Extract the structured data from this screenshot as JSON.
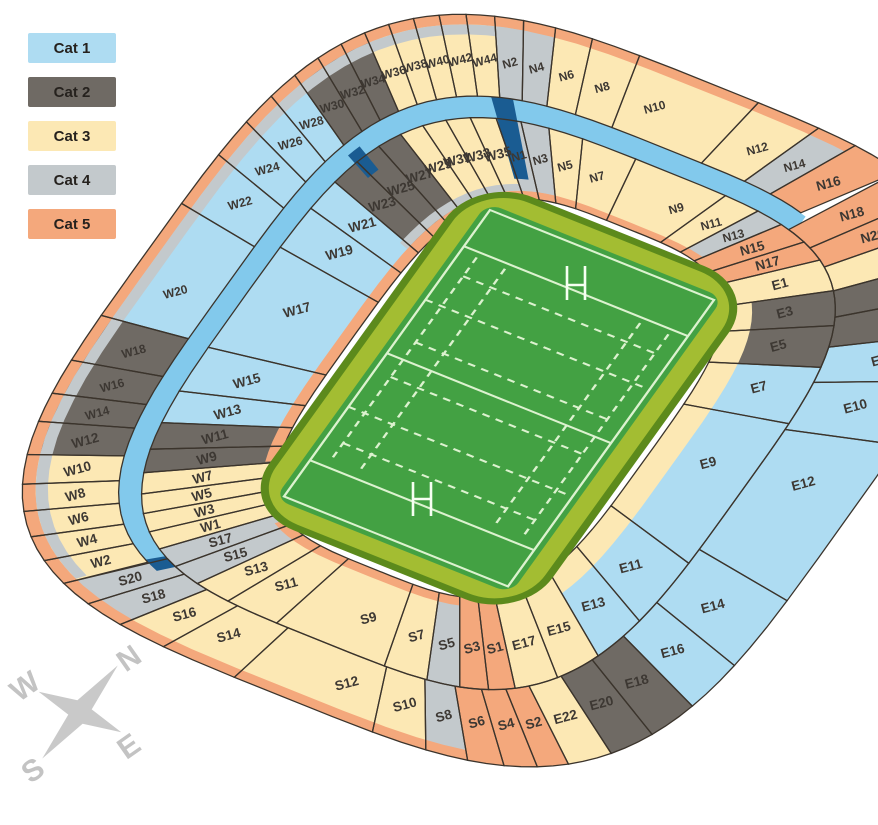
{
  "legend": {
    "items": [
      {
        "label": "Cat 1",
        "color": "#aedcf2"
      },
      {
        "label": "Cat 2",
        "color": "#6f6a64"
      },
      {
        "label": "Cat 3",
        "color": "#fce8b4"
      },
      {
        "label": "Cat 4",
        "color": "#c3c9cc"
      },
      {
        "label": "Cat 5",
        "color": "#f4a87c"
      }
    ]
  },
  "colors": {
    "walkway": "#82c9ec",
    "navy": "#1a5c92",
    "surround": "#a3bd32",
    "surround_edge": "#5c8a1c",
    "pitch": "#43a143",
    "pitch_line": "#dcf2cf",
    "border": "#3b342c",
    "label_text": "#3d3833",
    "compass": "#c9c9c9"
  },
  "stadium": {
    "inner_ring": [
      {
        "label": "W1",
        "cat": 3
      },
      {
        "label": "W3",
        "cat": 3
      },
      {
        "label": "W5",
        "cat": 3
      },
      {
        "label": "W7",
        "cat": 3
      },
      {
        "label": "W9",
        "cat": 2
      },
      {
        "label": "W11",
        "cat": 2
      },
      {
        "label": "W13",
        "cat": 1
      },
      {
        "label": "W15",
        "cat": 1
      },
      {
        "label": "W17",
        "cat": 1
      },
      {
        "label": "W19",
        "cat": 1
      },
      {
        "label": "W21",
        "cat": 1
      },
      {
        "label": "W23",
        "cat": 2
      },
      {
        "label": "W25",
        "cat": 2
      },
      {
        "label": "W27",
        "cat": 2
      },
      {
        "label": "W29",
        "cat": 3
      },
      {
        "label": "W31",
        "cat": 3
      },
      {
        "label": "W33",
        "cat": 3
      },
      {
        "label": "W35",
        "cat": 3
      },
      {
        "label": "N1",
        "cat": 4
      },
      {
        "label": "N3",
        "cat": 4
      },
      {
        "label": "N5",
        "cat": 3
      },
      {
        "label": "N7",
        "cat": 3
      },
      {
        "label": "N9",
        "cat": 3
      },
      {
        "label": "N11",
        "cat": 3
      },
      {
        "label": "N13",
        "cat": 4
      },
      {
        "label": "N15",
        "cat": 5
      },
      {
        "label": "N17",
        "cat": 5
      },
      {
        "label": "E1",
        "cat": 3
      },
      {
        "label": "E3",
        "cat": 2
      },
      {
        "label": "E5",
        "cat": 2
      },
      {
        "label": "E7",
        "cat": 1
      },
      {
        "label": "E9",
        "cat": 1
      },
      {
        "label": "E11",
        "cat": 1
      },
      {
        "label": "E13",
        "cat": 1
      },
      {
        "label": "E15",
        "cat": 3
      },
      {
        "label": "E17",
        "cat": 3
      },
      {
        "label": "S1",
        "cat": 5
      },
      {
        "label": "S3",
        "cat": 5
      },
      {
        "label": "S5",
        "cat": 4
      },
      {
        "label": "S7",
        "cat": 3
      },
      {
        "label": "S9",
        "cat": 3
      },
      {
        "label": "S11",
        "cat": 3
      },
      {
        "label": "S13",
        "cat": 3
      },
      {
        "label": "S15",
        "cat": 4
      },
      {
        "label": "S17",
        "cat": 4
      }
    ],
    "outer_ring": [
      {
        "label": "W2",
        "cat": 3
      },
      {
        "label": "W4",
        "cat": 3
      },
      {
        "label": "W6",
        "cat": 3
      },
      {
        "label": "W8",
        "cat": 3
      },
      {
        "label": "W10",
        "cat": 3
      },
      {
        "label": "W12",
        "cat": 2
      },
      {
        "label": "W14",
        "cat": 2
      },
      {
        "label": "W16",
        "cat": 2
      },
      {
        "label": "W18",
        "cat": 2
      },
      {
        "label": "W20",
        "cat": 1
      },
      {
        "label": "W22",
        "cat": 1
      },
      {
        "label": "W24",
        "cat": 1
      },
      {
        "label": "W26",
        "cat": 1
      },
      {
        "label": "W28",
        "cat": 1
      },
      {
        "label": "W30",
        "cat": 2
      },
      {
        "label": "W32",
        "cat": 2
      },
      {
        "label": "W34",
        "cat": 2
      },
      {
        "label": "W36",
        "cat": 3
      },
      {
        "label": "W38",
        "cat": 3
      },
      {
        "label": "W40",
        "cat": 3
      },
      {
        "label": "W42",
        "cat": 3
      },
      {
        "label": "W44",
        "cat": 3
      },
      {
        "label": "N2",
        "cat": 4
      },
      {
        "label": "N4",
        "cat": 4
      },
      {
        "label": "N6",
        "cat": 3
      },
      {
        "label": "N8",
        "cat": 3
      },
      {
        "label": "N10",
        "cat": 3
      },
      {
        "label": "N12",
        "cat": 3
      },
      {
        "label": "N14",
        "cat": 4
      },
      {
        "label": "N16",
        "cat": 5
      },
      {
        "label": "N18",
        "cat": 5
      },
      {
        "label": "N20",
        "cat": 5
      },
      {
        "label": "E2",
        "cat": 3
      },
      {
        "label": "E4",
        "cat": 2
      },
      {
        "label": "E6",
        "cat": 2
      },
      {
        "label": "E8",
        "cat": 1
      },
      {
        "label": "E10",
        "cat": 1
      },
      {
        "label": "E12",
        "cat": 1
      },
      {
        "label": "E14",
        "cat": 1
      },
      {
        "label": "E16",
        "cat": 1
      },
      {
        "label": "E18",
        "cat": 2
      },
      {
        "label": "E20",
        "cat": 2
      },
      {
        "label": "E22",
        "cat": 3
      },
      {
        "label": "S2",
        "cat": 5
      },
      {
        "label": "S4",
        "cat": 5
      },
      {
        "label": "S6",
        "cat": 5
      },
      {
        "label": "S8",
        "cat": 4
      },
      {
        "label": "S10",
        "cat": 3
      },
      {
        "label": "S12",
        "cat": 3
      },
      {
        "label": "S14",
        "cat": 3
      },
      {
        "label": "S16",
        "cat": 3
      },
      {
        "label": "S18",
        "cat": 4
      },
      {
        "label": "S20",
        "cat": 4
      }
    ]
  },
  "compass": {
    "n": "N",
    "e": "E",
    "s": "S",
    "w": "W"
  }
}
